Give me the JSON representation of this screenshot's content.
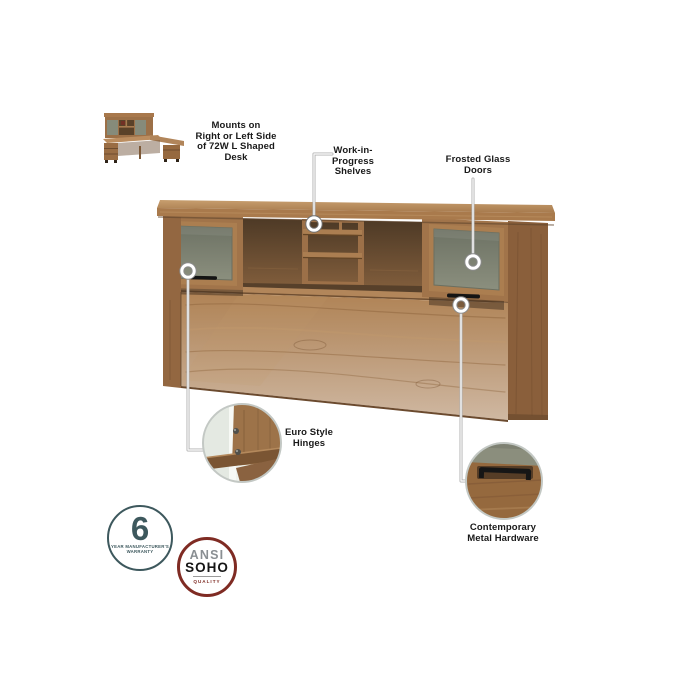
{
  "image_type": "annotated-product-feature-diagram",
  "product": {
    "name_hint": "desk hutch",
    "thumbnail": "l-shaped-desk-with-hutch"
  },
  "callouts": {
    "mounts_label": "Mounts on\nRight or Left Side\nof 72W L Shaped\nDesk",
    "shelves_label": "Work-in-\nProgress\nShelves",
    "doors_label": "Frosted Glass\nDoors",
    "hinges_label": "Euro Style\nHinges",
    "hardware_label": "Contemporary\nMetal Hardware"
  },
  "badges": {
    "warranty": {
      "value": "6",
      "caption_line1": "YEAR MANUFACTURER'S",
      "caption_line2": "WARRANTY",
      "color": "#3d585d"
    },
    "quality": {
      "line1": "ANSI",
      "line2": "SOHO",
      "line3": "QUALITY",
      "ring_color": "#7f2b23"
    }
  },
  "colors": {
    "background": "#ffffff",
    "wood_base": "#a3754a",
    "wood_light": "#b98c5e",
    "wood_dark": "#7b5636",
    "interior_shadow": "#533d28",
    "frosted_glass": "#7d8170",
    "handle_black": "#161616",
    "callout_line": "#b5b5b5",
    "label_text": "#191919"
  }
}
